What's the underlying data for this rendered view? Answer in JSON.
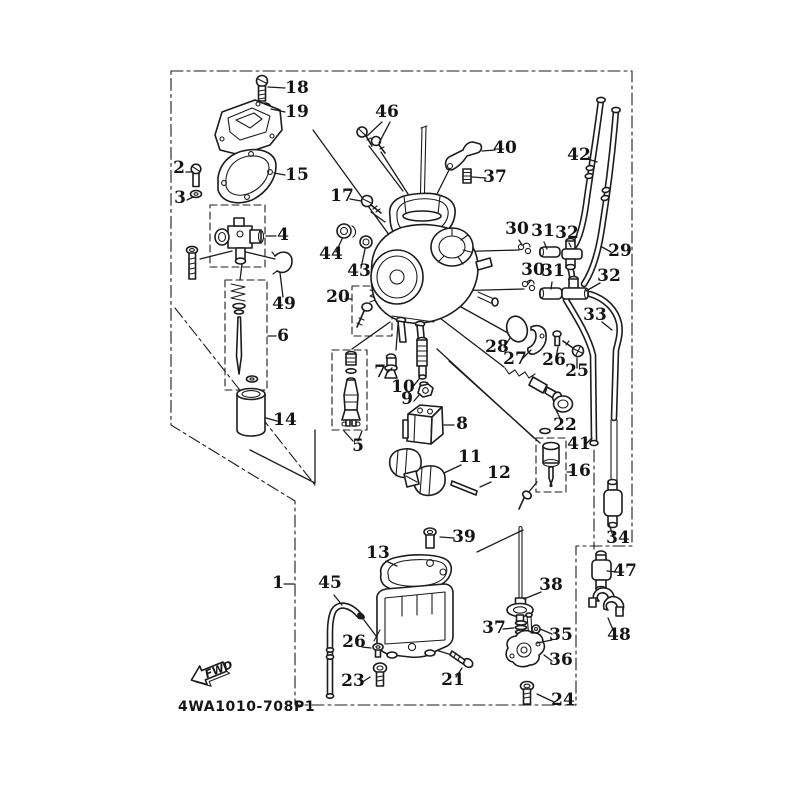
{
  "page": {
    "background": "#ffffff",
    "ink": "#1c1c1c"
  },
  "diagram": {
    "code": "4WA1010-708P1",
    "fwd_label": "FWD",
    "callouts": [
      {
        "n": "18",
        "x": 297,
        "y": 93,
        "l": [
          [
            [
              285,
              88
            ],
            [
              268,
              87
            ]
          ]
        ]
      },
      {
        "n": "19",
        "x": 297,
        "y": 117,
        "l": [
          [
            [
              285,
              112
            ],
            [
              271,
              109
            ]
          ]
        ]
      },
      {
        "n": "2",
        "x": 179,
        "y": 173,
        "l": [
          [
            [
              186,
              172
            ],
            [
              193,
              172
            ]
          ]
        ]
      },
      {
        "n": "3",
        "x": 180,
        "y": 203,
        "l": [
          [
            [
              187,
              200
            ],
            [
              193,
              197
            ]
          ]
        ]
      },
      {
        "n": "15",
        "x": 297,
        "y": 180,
        "l": [
          [
            [
              285,
              175
            ],
            [
              274,
              173
            ]
          ]
        ]
      },
      {
        "n": "4",
        "x": 283,
        "y": 240,
        "l": [
          [
            [
              276,
              236
            ],
            [
              266,
              236
            ]
          ]
        ]
      },
      {
        "n": "49",
        "x": 284,
        "y": 309,
        "l": [
          [
            [
              283,
              297
            ],
            [
              280,
              273
            ]
          ]
        ]
      },
      {
        "n": "46",
        "x": 387,
        "y": 117,
        "l": [
          [
            [
              382,
              122
            ],
            [
              367,
              136
            ]
          ],
          [
            [
              390,
              122
            ],
            [
              379,
              143
            ]
          ]
        ]
      },
      {
        "n": "17",
        "x": 342,
        "y": 201,
        "l": [
          [
            [
              350,
              199
            ],
            [
              361,
              201
            ]
          ]
        ]
      },
      {
        "n": "44",
        "x": 331,
        "y": 259,
        "l": [
          [
            [
              336,
              252
            ],
            [
              342,
              239
            ]
          ]
        ]
      },
      {
        "n": "43",
        "x": 359,
        "y": 276,
        "l": [
          [
            [
              361,
              268
            ],
            [
              365,
              249
            ]
          ]
        ]
      },
      {
        "n": "20",
        "x": 338,
        "y": 302,
        "l": [
          [
            [
              345,
              299
            ],
            [
              352,
              299
            ]
          ]
        ]
      },
      {
        "n": "40",
        "x": 505,
        "y": 153,
        "l": [
          [
            [
              495,
              150
            ],
            [
              482,
              151
            ]
          ]
        ]
      },
      {
        "n": "37",
        "x": 495,
        "y": 182,
        "l": [
          [
            [
              486,
              178
            ],
            [
              472,
              177
            ]
          ]
        ]
      },
      {
        "n": "42",
        "x": 579,
        "y": 160,
        "l": [
          [
            [
              588,
              159
            ],
            [
              597,
              162
            ]
          ]
        ]
      },
      {
        "n": "29",
        "x": 620,
        "y": 256,
        "l": [
          [
            [
              611,
              252
            ],
            [
              602,
              247
            ]
          ]
        ]
      },
      {
        "n": "30",
        "x": 517,
        "y": 234,
        "l": [
          [
            [
              519,
              240
            ],
            [
              522,
              245
            ]
          ]
        ]
      },
      {
        "n": "31",
        "x": 543,
        "y": 236,
        "l": [
          [
            [
              544,
              242
            ],
            [
              547,
              249
            ]
          ]
        ]
      },
      {
        "n": "32",
        "x": 567,
        "y": 238,
        "l": [
          [
            [
              569,
              243
            ],
            [
              571,
              247
            ]
          ]
        ]
      },
      {
        "n": "30",
        "x": 533,
        "y": 275,
        "l": [
          [
            [
              531,
              280
            ],
            [
              528,
              284
            ]
          ]
        ]
      },
      {
        "n": "31",
        "x": 553,
        "y": 276,
        "l": [
          [
            [
              552,
              282
            ],
            [
              551,
              289
            ]
          ]
        ]
      },
      {
        "n": "32",
        "x": 609,
        "y": 281,
        "l": [
          [
            [
              600,
              283
            ],
            [
              586,
              291
            ]
          ]
        ]
      },
      {
        "n": "33",
        "x": 595,
        "y": 320,
        "l": [
          [
            [
              602,
              322
            ],
            [
              612,
              330
            ]
          ]
        ]
      },
      {
        "n": "28",
        "x": 497,
        "y": 352,
        "l": [
          [
            [
              504,
              347
            ],
            [
              510,
              338
            ]
          ]
        ]
      },
      {
        "n": "27",
        "x": 515,
        "y": 364,
        "l": [
          [
            [
              522,
              359
            ],
            [
              531,
              350
            ]
          ]
        ]
      },
      {
        "n": "26",
        "x": 554,
        "y": 365,
        "l": [
          [
            [
              556,
              358
            ],
            [
              558,
              347
            ]
          ]
        ]
      },
      {
        "n": "25",
        "x": 577,
        "y": 376,
        "l": [
          [
            [
              577,
              368
            ],
            [
              577,
              358
            ]
          ]
        ]
      },
      {
        "n": "22",
        "x": 565,
        "y": 430,
        "l": [
          [
            [
              562,
              422
            ],
            [
              556,
              410
            ]
          ]
        ]
      },
      {
        "n": "41",
        "x": 579,
        "y": 449,
        "l": [
          [
            [
              585,
              445
            ],
            [
              592,
              438
            ]
          ]
        ]
      },
      {
        "n": "16",
        "x": 579,
        "y": 476,
        "l": [
          [
            [
              572,
              472
            ],
            [
              567,
              472
            ]
          ]
        ]
      },
      {
        "n": "34",
        "x": 618,
        "y": 543,
        "l": [
          [
            [
              613,
              536
            ],
            [
              609,
              524
            ]
          ]
        ]
      },
      {
        "n": "47",
        "x": 625,
        "y": 576,
        "l": [
          [
            [
              617,
              572
            ],
            [
              607,
              571
            ]
          ]
        ]
      },
      {
        "n": "48",
        "x": 619,
        "y": 640,
        "l": [
          [
            [
              614,
              632
            ],
            [
              608,
              618
            ]
          ]
        ]
      },
      {
        "n": "6",
        "x": 283,
        "y": 341,
        "l": [
          [
            [
              276,
              336
            ],
            [
              268,
              336
            ]
          ]
        ]
      },
      {
        "n": "14",
        "x": 285,
        "y": 425,
        "l": [
          [
            [
              277,
              421
            ],
            [
              266,
              418
            ]
          ]
        ]
      },
      {
        "n": "7",
        "x": 380,
        "y": 377,
        "l": [
          [
            [
              387,
              373
            ],
            [
              392,
              368
            ]
          ]
        ]
      },
      {
        "n": "10",
        "x": 403,
        "y": 392,
        "l": [
          [
            [
              412,
              388
            ],
            [
              419,
              379
            ]
          ]
        ]
      },
      {
        "n": "9",
        "x": 407,
        "y": 404,
        "l": [
          [
            [
              414,
              401
            ],
            [
              420,
              394
            ]
          ]
        ]
      },
      {
        "n": "8",
        "x": 462,
        "y": 429,
        "l": [
          [
            [
              454,
              425
            ],
            [
              444,
              425
            ]
          ]
        ]
      },
      {
        "n": "11",
        "x": 470,
        "y": 462,
        "l": [
          [
            [
              461,
              465
            ],
            [
              444,
              473
            ]
          ]
        ]
      },
      {
        "n": "12",
        "x": 499,
        "y": 478,
        "l": [
          [
            [
              491,
              482
            ],
            [
              480,
              487
            ]
          ]
        ]
      },
      {
        "n": "5",
        "x": 358,
        "y": 451,
        "l": [
          [
            [
              353,
              441
            ],
            [
              344,
              431
            ]
          ],
          [
            [
              358,
              441
            ],
            [
              362,
              431
            ]
          ]
        ]
      },
      {
        "n": "39",
        "x": 464,
        "y": 542,
        "l": [
          [
            [
              454,
              538
            ],
            [
              440,
              537
            ]
          ]
        ]
      },
      {
        "n": "38",
        "x": 551,
        "y": 590,
        "l": [
          [
            [
              541,
              592
            ],
            [
              524,
              599
            ]
          ]
        ]
      },
      {
        "n": "37",
        "x": 494,
        "y": 633,
        "l": [
          [
            [
              503,
              629
            ],
            [
              514,
              628
            ]
          ]
        ]
      },
      {
        "n": "35",
        "x": 561,
        "y": 640,
        "l": [
          [
            [
              552,
              634
            ],
            [
              540,
              629
            ]
          ],
          [
            [
              552,
              640
            ],
            [
              537,
              643
            ]
          ]
        ]
      },
      {
        "n": "36",
        "x": 561,
        "y": 665,
        "l": [
          [
            [
              552,
              661
            ],
            [
              544,
              655
            ]
          ]
        ]
      },
      {
        "n": "24",
        "x": 563,
        "y": 705,
        "l": [
          [
            [
              554,
              702
            ],
            [
              537,
              694
            ]
          ]
        ]
      },
      {
        "n": "21",
        "x": 453,
        "y": 685,
        "l": [
          [
            [
              456,
              677
            ],
            [
              462,
              668
            ]
          ]
        ]
      },
      {
        "n": "13",
        "x": 378,
        "y": 558,
        "l": [
          [
            [
              386,
              561
            ],
            [
              397,
              566
            ]
          ]
        ]
      },
      {
        "n": "45",
        "x": 330,
        "y": 588,
        "l": [
          [
            [
              334,
              595
            ],
            [
              342,
              605
            ]
          ]
        ]
      },
      {
        "n": "26",
        "x": 354,
        "y": 647,
        "l": [
          [
            [
              362,
              647
            ],
            [
              371,
              648
            ]
          ]
        ]
      },
      {
        "n": "23",
        "x": 353,
        "y": 686,
        "l": [
          [
            [
              361,
              683
            ],
            [
              370,
              677
            ]
          ]
        ]
      },
      {
        "n": "1",
        "x": 278,
        "y": 588,
        "l": [
          [
            [
              284,
              584
            ],
            [
              294,
              584
            ]
          ]
        ]
      }
    ]
  }
}
